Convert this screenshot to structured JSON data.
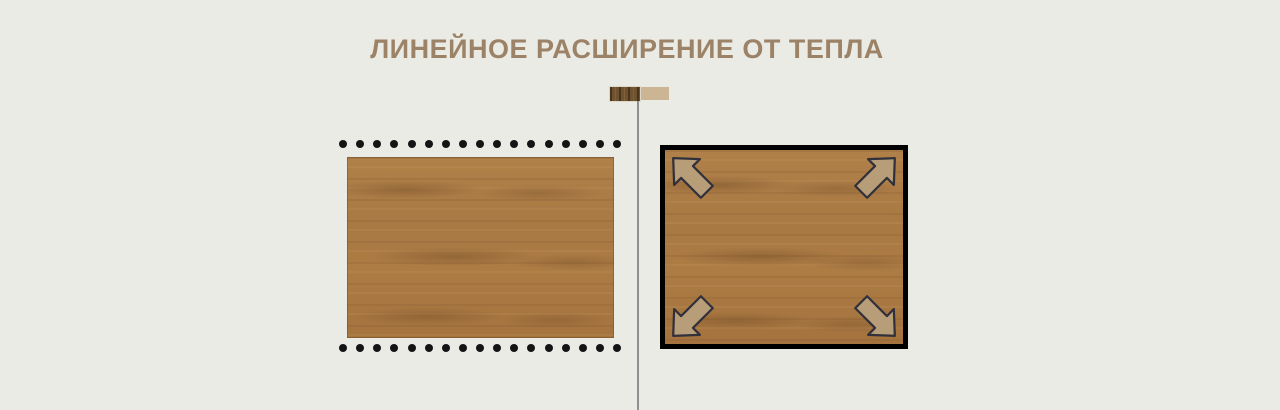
{
  "title": "ЛИНЕЙНОЕ РАСШИРЕНИЕ ОТ ТЕПЛА",
  "legend": {
    "icons": [
      "dark-wood-swatch-icon",
      "light-wood-swatch-icon"
    ]
  },
  "panels": {
    "left": {
      "name": "board-with-dotted-edges",
      "dots_per_row": 17,
      "dot_rows": [
        "top",
        "bottom"
      ]
    },
    "right": {
      "name": "framed-board-expanding",
      "arrows": [
        "up-left",
        "up-right",
        "down-left",
        "down-right"
      ]
    }
  },
  "colors": {
    "background": "#ebebe5",
    "title": "#9c8266",
    "dot": "#141414",
    "divider": "#8f8f8f",
    "wood_base": "#aa7a44",
    "dark_swatch_wood": "#6f5230",
    "light_swatch": "#cbb593",
    "frame": "#000000",
    "arrow_fill": "#b89d79",
    "arrow_stroke": "#31313b"
  }
}
